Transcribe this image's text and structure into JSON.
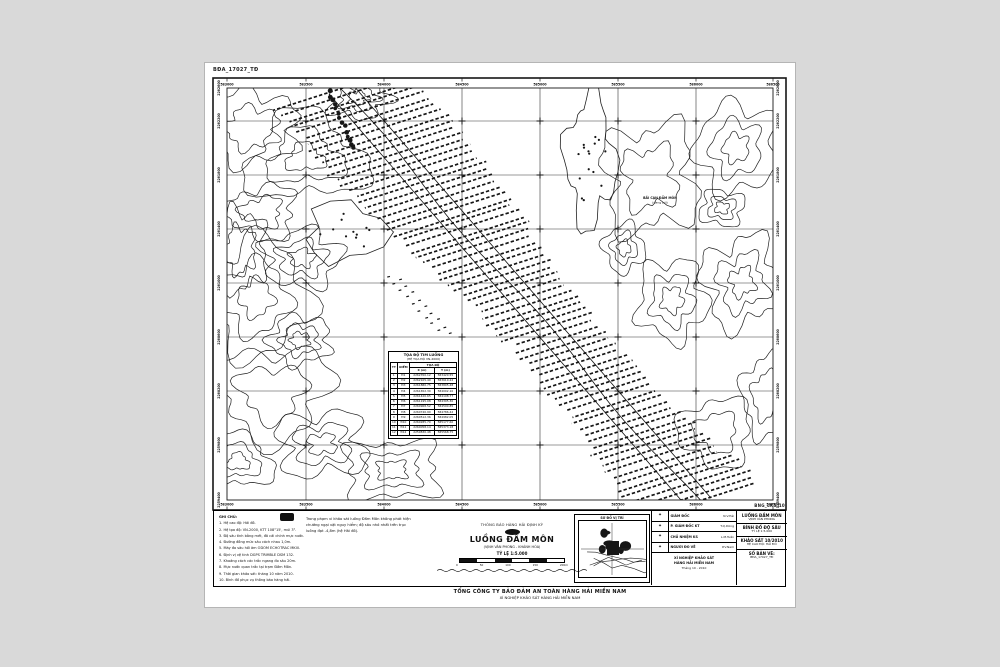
{
  "page": {
    "bg": "#d9d9d9",
    "sheet": "#ffffff",
    "ink": "#111111"
  },
  "codes": {
    "top_left": "BĐA_17027_TĐ",
    "bottom_right": "BNG_LKS_10"
  },
  "map": {
    "x_ticks": [
      "583000",
      "583500",
      "584000",
      "584500",
      "585000",
      "585500",
      "586000",
      "586500"
    ],
    "y_ticks": [
      "2262600",
      "2262200",
      "2261800",
      "2261400",
      "2261000",
      "2260600",
      "2260200",
      "2259800",
      "2259400"
    ],
    "shoal_label_1": "BÃI CẠN ĐẦM MÔN",
    "shoal_label_2": "(đang bồi)"
  },
  "coord_table": {
    "title": "TỌA ĐỘ TIM LUỒNG",
    "subtitle": "(HỆ TỌA ĐỘ VN-2000)",
    "col_tt": "TT",
    "col_diem": "ĐIỂM",
    "col_group": "TỌA ĐỘ",
    "col_x": "X (m)",
    "col_y": "Y (m)",
    "rows": [
      [
        "1",
        "Đ1",
        "2262350.12",
        "583420.55"
      ],
      [
        "2",
        "Đ2",
        "2262105.40",
        "583610.22"
      ],
      [
        "3",
        "Đ3",
        "2261880.75",
        "583805.48"
      ],
      [
        "4",
        "Đ4",
        "2261652.30",
        "584002.10"
      ],
      [
        "5",
        "Đ5",
        "2261420.65",
        "584198.77"
      ],
      [
        "6",
        "Đ6",
        "2261195.08",
        "584395.30"
      ],
      [
        "7",
        "Đ7",
        "2260968.52",
        "584590.85"
      ],
      [
        "8",
        "Đ8",
        "2260740.90",
        "584786.42"
      ],
      [
        "9",
        "Đ9",
        "2260512.36",
        "584982.05"
      ],
      [
        "10",
        "Đ10",
        "2260285.70",
        "585177.60"
      ],
      [
        "11",
        "Đ11",
        "2260058.14",
        "585373.18"
      ],
      [
        "12",
        "Đ12",
        "2259830.48",
        "585568.75"
      ]
    ]
  },
  "title_block": {
    "notes_heading": "GHI CHÚ:",
    "notes": [
      "1. Hệ cao độ: Hải đồ.",
      "2. Hệ tọa độ: VN-2000, KTT 108°15', múi 3°.",
      "3. Độ sâu tính bằng mét, đã cải chính mực nước.",
      "4. Đường đồng mức sâu cách nhau 1,0m.",
      "5. Máy đo sâu hồi âm ODOM ECHOTRAC MKIII.",
      "6. Định vị vệ tinh DGPS TRIMBLE DSM 132.",
      "7. Khoảng cách các trắc ngang đo sâu 20m.",
      "8. Mực nước quan trắc tại trạm Đầm Môn.",
      "9. Thời gian khảo sát: tháng 10 năm 2010.",
      "10. Bình đồ phục vụ thông báo hàng hải."
    ],
    "paragraph": [
      "Trong phạm vi khảo sát luồng Đầm Môn không phát hiện",
      "chướng ngại vật nguy hiểm; độ sâu nhỏ nhất trên trục",
      "luồng đạt -4,8m (hệ Hải đồ)."
    ],
    "center": {
      "line0": "THÔNG BÁO HÀNG HẢI ĐỊNH KỲ",
      "name": "LUỒNG ĐẦM MÔN",
      "sub": "(VỊNH VÂN PHONG - KHÁNH HÒA)",
      "scale_label": "TỶ LỆ 1:5.000",
      "scale_ticks": [
        "0",
        "50",
        "100",
        "150",
        "200m"
      ]
    },
    "inset_title": "SƠ ĐỒ VỊ TRÍ",
    "signatures": [
      {
        "stamp": "✦",
        "role": "GIÁM ĐỐC",
        "who": "N.V.Hải"
      },
      {
        "stamp": "✦",
        "role": "P. GIÁM ĐỐC KT",
        "who": "T.Q.Dũng"
      },
      {
        "stamp": "✦",
        "role": "CHỦ NHIỆM KS",
        "who": "L.M.Tuấn"
      },
      {
        "stamp": "✦",
        "role": "NGƯỜI ĐO VẼ",
        "who": "P.V.Nam"
      }
    ],
    "sign_foot_1": "XÍ NGHIỆP KHẢO SÁT",
    "sign_foot_2": "HÀNG HẢI MIỀN NAM",
    "sign_date": "Tháng 10 - 2010",
    "info_blocks": [
      {
        "b1": "LUỒNG ĐẦM MÔN",
        "b2": "VỊNH VÂN PHONG"
      },
      {
        "b1": "BÌNH ĐỒ ĐỘ SÂU",
        "b2": "TỶ LỆ 1:5.000"
      },
      {
        "b1": "KHẢO SÁT 10/2010",
        "b2": "HỆ CAO ĐỘ: HẢI ĐỒ"
      },
      {
        "b1": "SỐ BẢN VẼ:",
        "b2": "BĐA_17027_TĐ"
      }
    ],
    "bottom_line_1": "TỔNG CÔNG TY BẢO ĐẢM AN TOÀN HÀNG HẢI MIỀN NAM",
    "bottom_line_2": "XÍ NGHIỆP KHẢO SÁT HÀNG HẢI MIỀN NAM"
  }
}
